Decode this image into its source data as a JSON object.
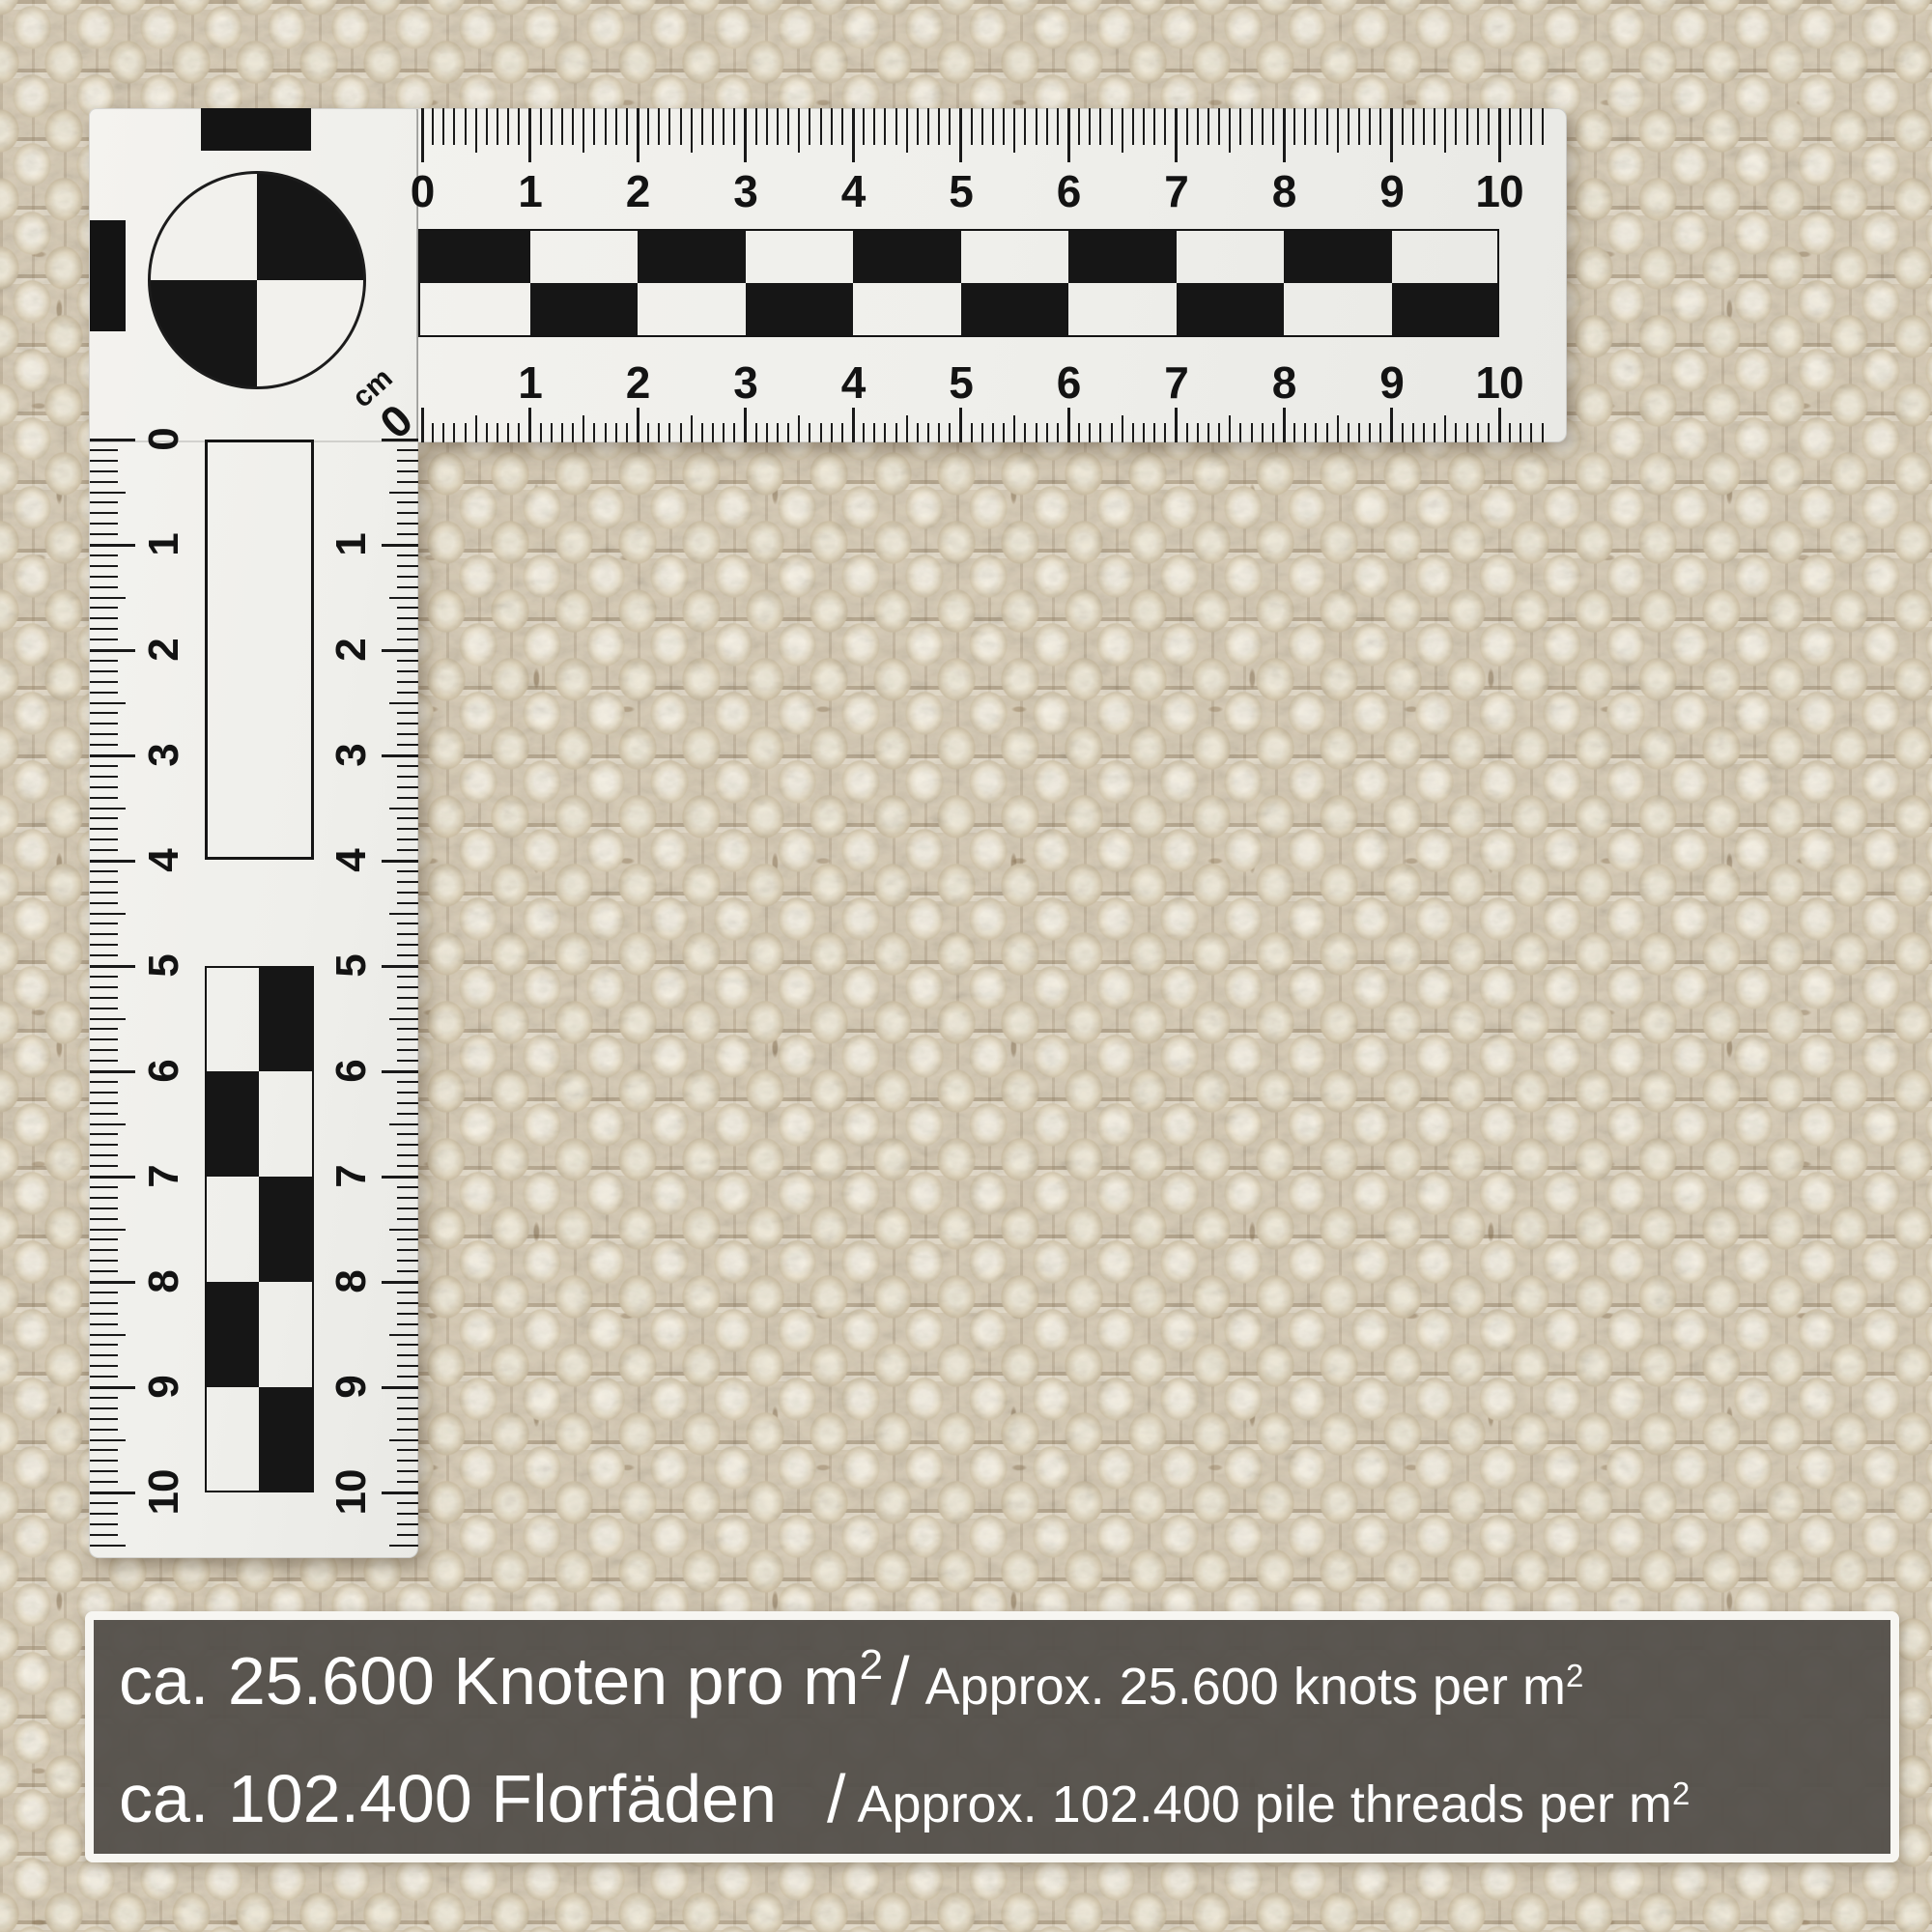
{
  "overlay": {
    "background_color": "#54504b",
    "text_color": "#ffffff",
    "lines": [
      {
        "de": "ca. 25.600 Knoten pro m",
        "de_sup": "2",
        "sep": "/",
        "en": "Approx. 25.600 knots per m",
        "en_sup": "2"
      },
      {
        "de": "ca. 102.400 Florfäden",
        "de_sup": "",
        "sep": "/",
        "en": "Approx. 102.400 pile threads per m",
        "en_sup": "2"
      }
    ]
  },
  "ruler": {
    "unit": "cm",
    "corner_zero": "0",
    "top_labels": [
      "0",
      "1",
      "2",
      "3",
      "4",
      "5",
      "6",
      "7",
      "8",
      "9",
      "10"
    ],
    "bottom_labels": [
      "1",
      "2",
      "3",
      "4",
      "5",
      "6",
      "7",
      "8",
      "9",
      "10"
    ],
    "left_labels": [
      "0",
      "1",
      "2",
      "3",
      "4",
      "5",
      "6",
      "7",
      "8",
      "9",
      "10"
    ],
    "right_labels": [
      "1",
      "2",
      "3",
      "4",
      "5",
      "6",
      "7",
      "8",
      "9",
      "10"
    ]
  }
}
